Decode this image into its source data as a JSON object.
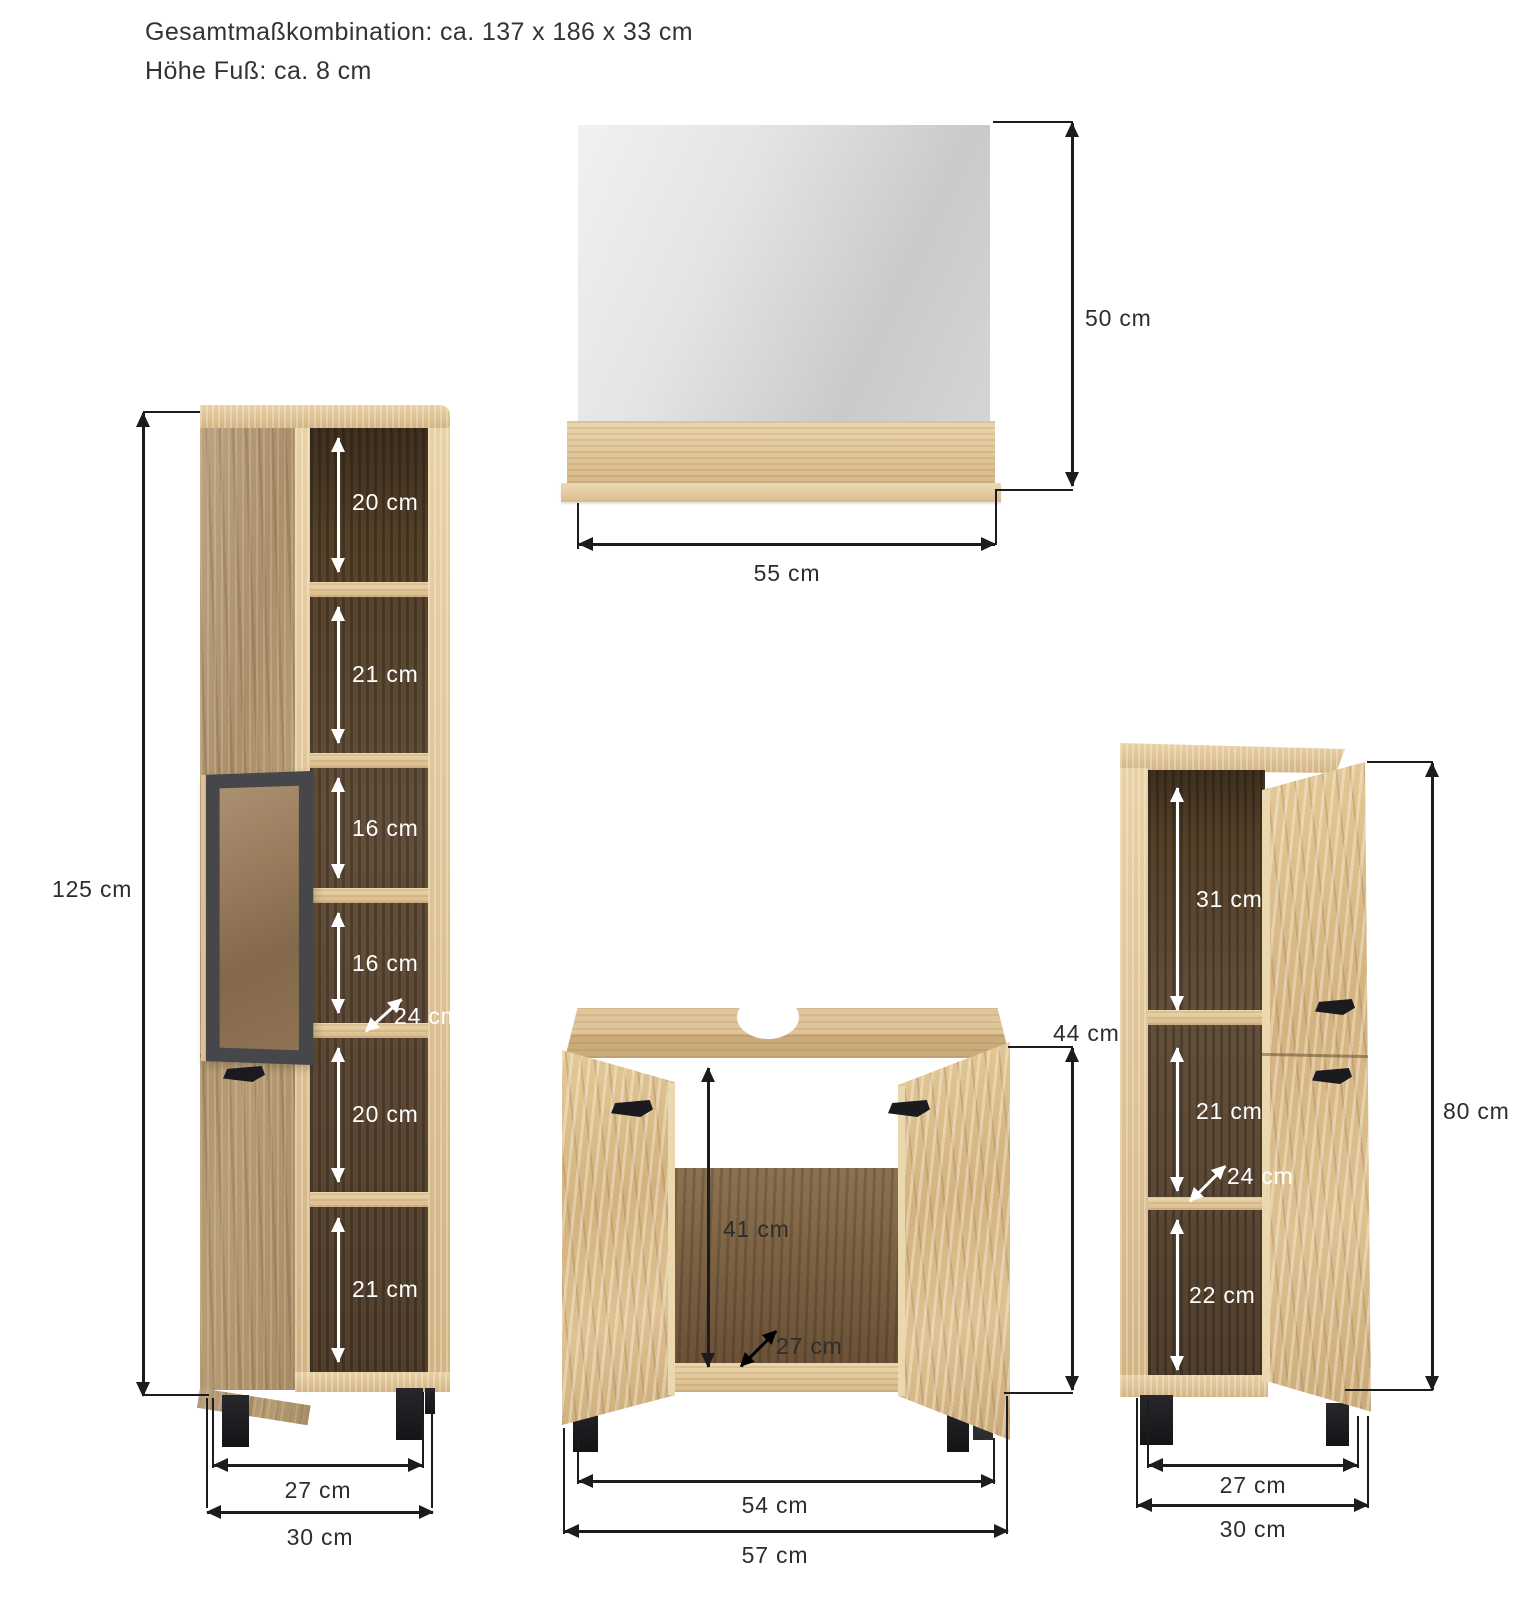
{
  "title": {
    "line1": "Gesamtmaßkombination: ca. 137 x 186 x 33 cm",
    "line2": "Höhe Fuß: ca. 8 cm"
  },
  "mirror": {
    "height": "50 cm",
    "width": "55 cm"
  },
  "tall_cabinet": {
    "height": "125 cm",
    "compartments": [
      "20 cm",
      "21 cm",
      "16 cm",
      "16 cm",
      "20 cm",
      "21 cm"
    ],
    "depth": "24 cm",
    "width_inner": "27 cm",
    "width_outer": "30 cm"
  },
  "vanity_cabinet": {
    "height": "44 cm",
    "inner_height": "41 cm",
    "depth": "27 cm",
    "width_inner": "54 cm",
    "width_outer": "57 cm"
  },
  "side_cabinet": {
    "height": "80 cm",
    "compartments": [
      "31 cm",
      "21 cm",
      "22 cm"
    ],
    "depth": "24 cm",
    "width_inner": "27 cm",
    "width_outer": "30 cm"
  },
  "colors": {
    "background": "#ffffff",
    "dimension_line": "#1c1c1c",
    "label_dark": "#2d2d2d",
    "label_light": "#ffffff",
    "wood_light": "#e2c79c",
    "wood_medium": "#b3966e",
    "wood_interior_dark": "#5a4632",
    "glass_frame": "#46474b",
    "hardware_black": "#1a1a1d",
    "mirror_gray": "#d0d2d4"
  }
}
